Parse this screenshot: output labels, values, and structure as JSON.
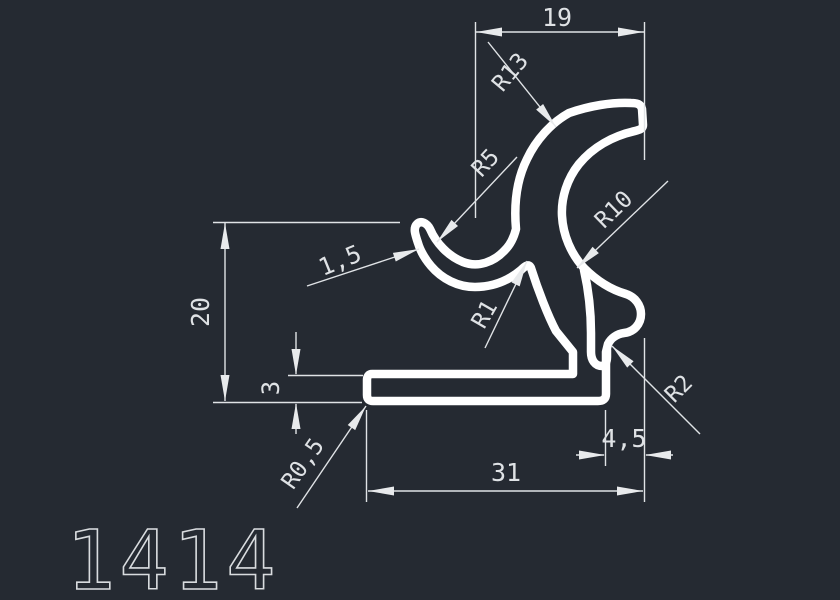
{
  "canvas": {
    "background": "#252a32",
    "profile_color": "#ffffff",
    "dimension_color": "#e0e3e6",
    "text_color": "#d9dcdf"
  },
  "drawing": {
    "part_number": "1414"
  },
  "dimensions": {
    "width_top": "19",
    "height_left": "20",
    "flange_thickness": "3",
    "width_bottom": "31",
    "tab_width": "4,5",
    "wall_thickness": "1,5",
    "radius_top_arc": "R13",
    "radius_hook_inner": "R5",
    "radius_c_inner": "R10",
    "radius_stem_notch": "R1",
    "radius_foot_notch": "R2",
    "radius_flange_corner": "R0,5"
  }
}
